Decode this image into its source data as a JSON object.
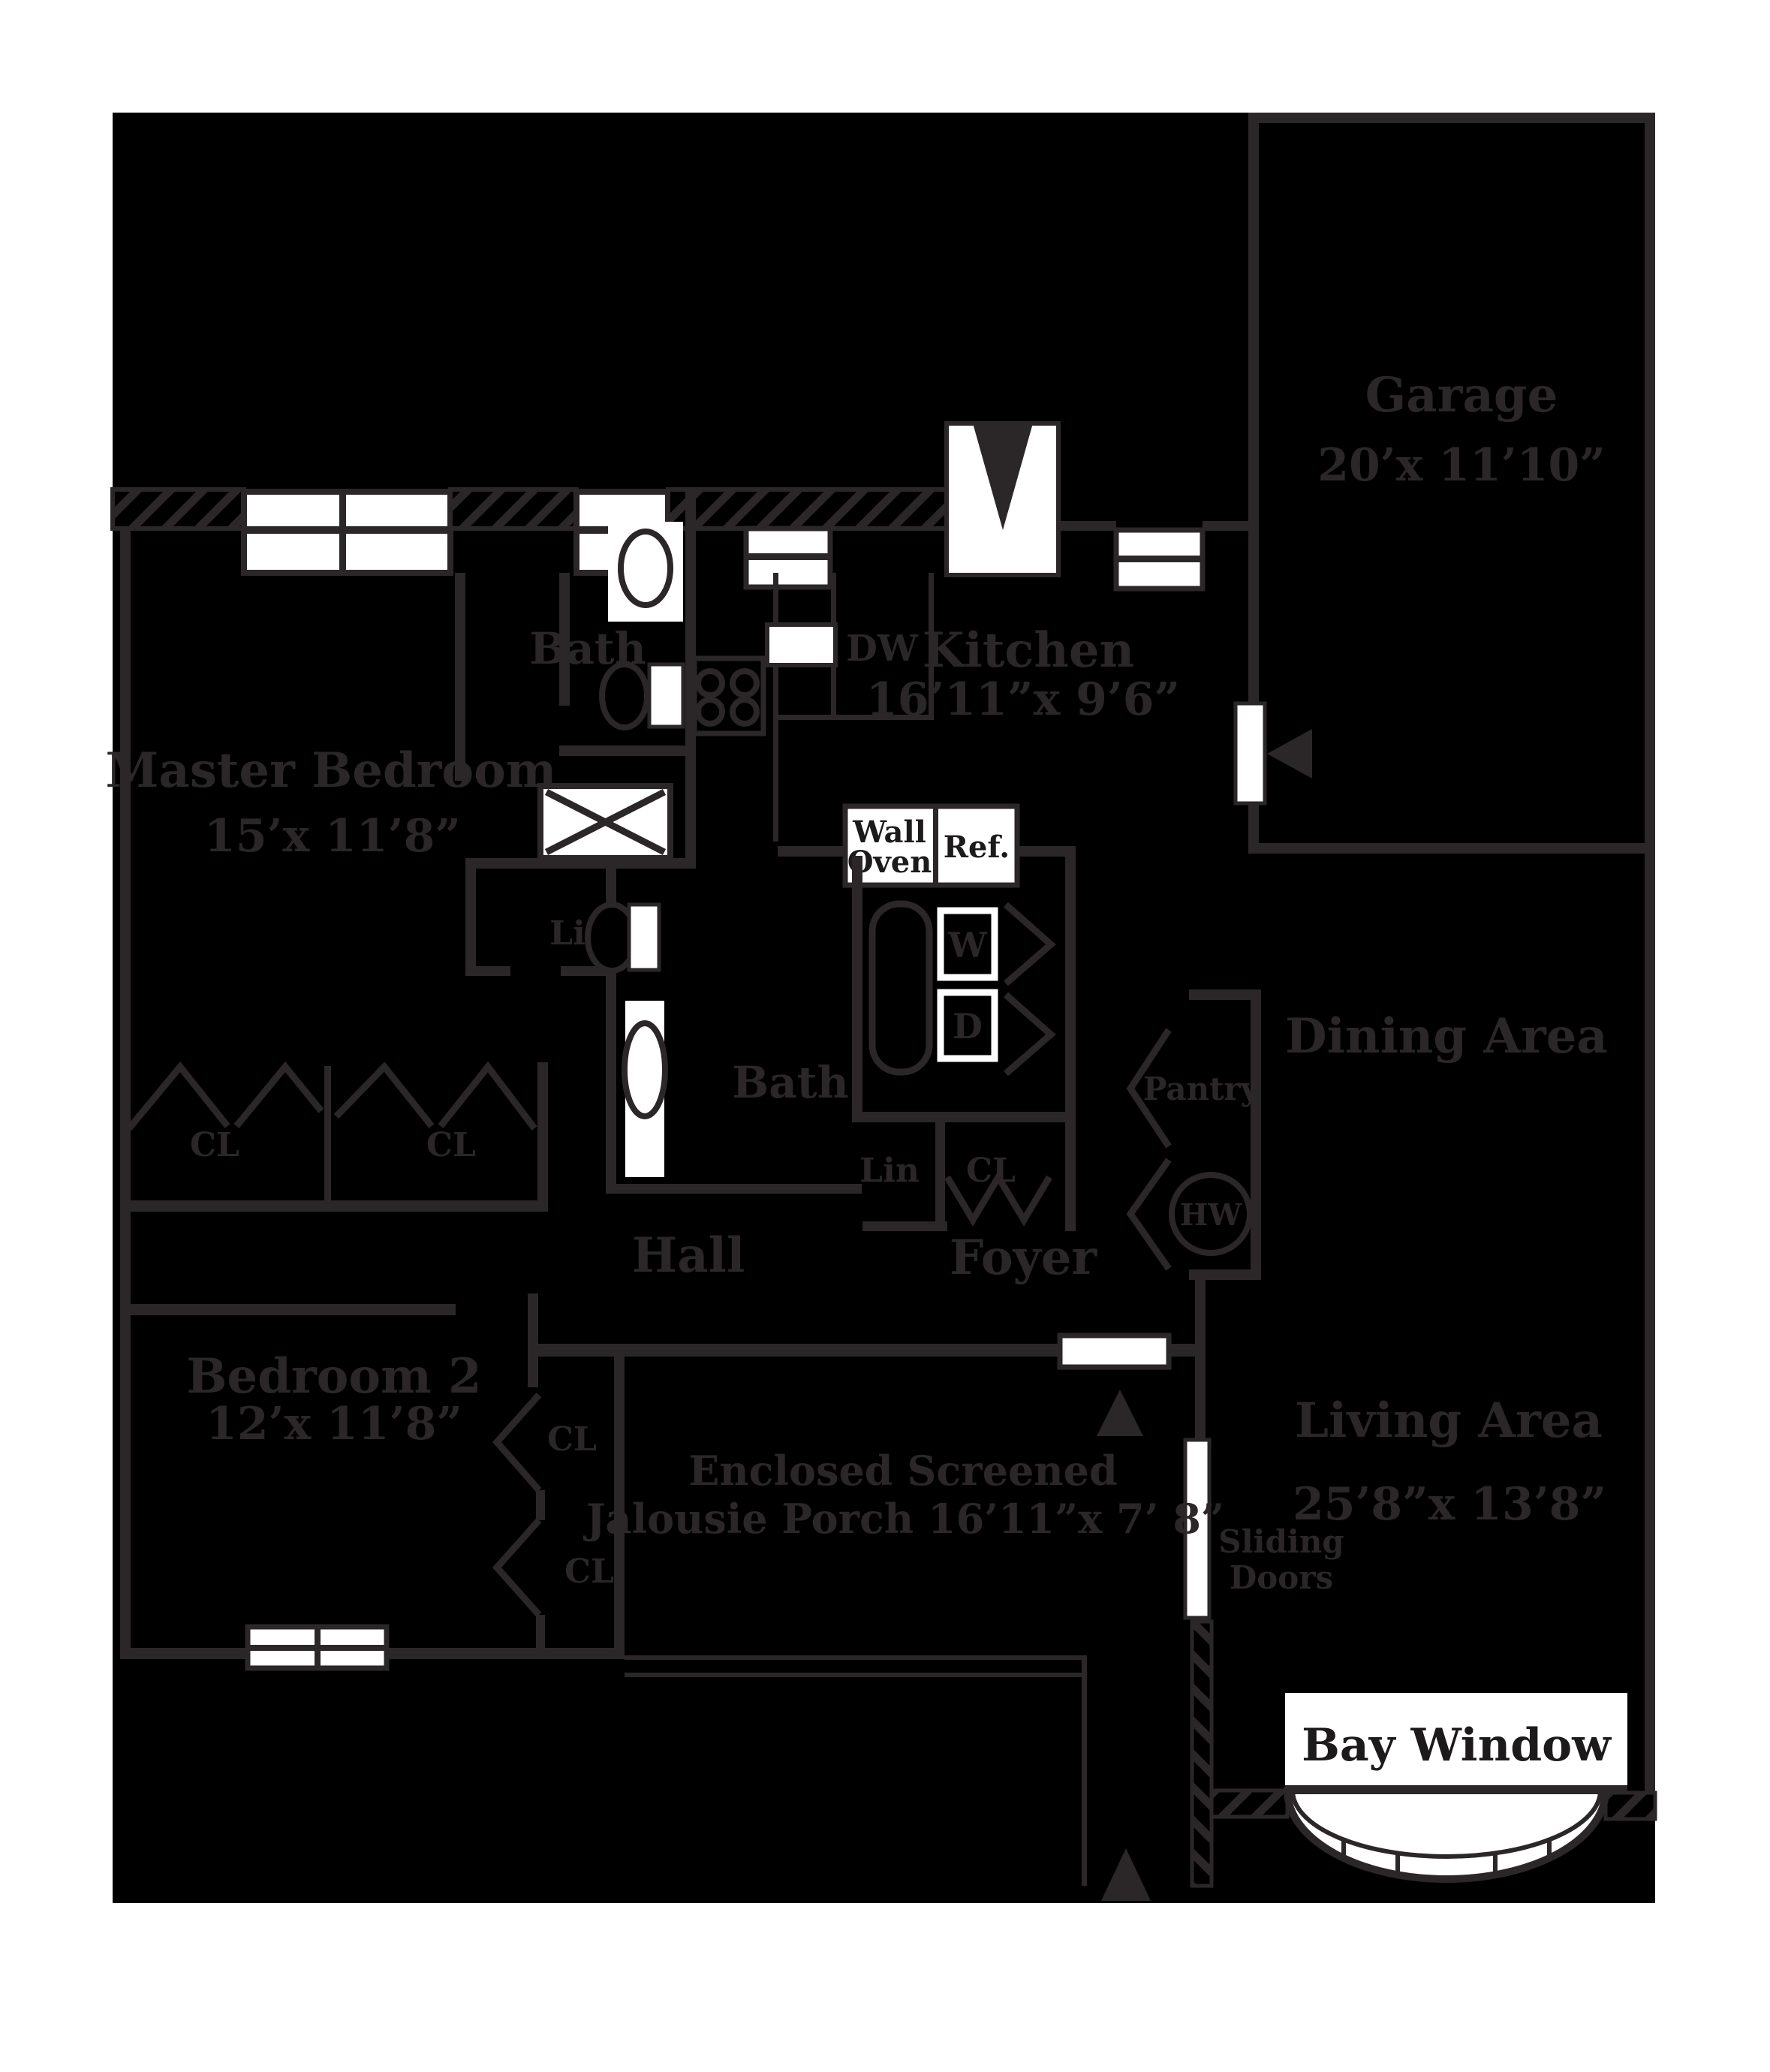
{
  "colors": {
    "page_bg": "#ffffff",
    "plan_bg": "#000000",
    "wall_gray": "#2b2728",
    "fixture_white": "#ffffff",
    "label_on_white": "#1d1a1b"
  },
  "rooms": {
    "garage": {
      "name": "Garage",
      "dims": "20’x 11’10”"
    },
    "kitchen": {
      "name": "Kitchen",
      "dims": "16’11”x 9’6”"
    },
    "master_bedroom": {
      "name": "Master Bedroom",
      "dims": "15’x 11’8”"
    },
    "bedroom2": {
      "name": "Bedroom 2",
      "dims": "12’x 11’8”"
    },
    "living_area": {
      "name": "Living Area",
      "dims": "25’8”x 13’8”"
    },
    "dining_area": {
      "name": "Dining Area"
    },
    "bath_upper": {
      "name": "Bath"
    },
    "bath_lower": {
      "name": "Bath"
    },
    "hall": {
      "name": "Hall"
    },
    "foyer": {
      "name": "Foyer"
    },
    "porch": {
      "name_line1": "Enclosed Screened",
      "name_line2": "Jalousie Porch 16’11”x 7’ 8”"
    }
  },
  "fixtures": {
    "dishwasher": "DW",
    "wall_oven_line1": "Wall",
    "wall_oven_line2": "Oven",
    "refrigerator": "Ref.",
    "washer": "W",
    "dryer": "D",
    "pantry": "Pantry",
    "water_heater": "HW",
    "bay_window": "Bay Window",
    "sliding_doors_line1": "Sliding",
    "sliding_doors_line2": "Doors"
  },
  "closets": {
    "linen_upper": "Lin",
    "linen_foyer": "Lin",
    "closet_foyer": "CL",
    "closet_master_left": "CL",
    "closet_master_right": "CL",
    "closet_bedroom2_upper": "CL",
    "closet_bedroom2_lower": "CL"
  }
}
